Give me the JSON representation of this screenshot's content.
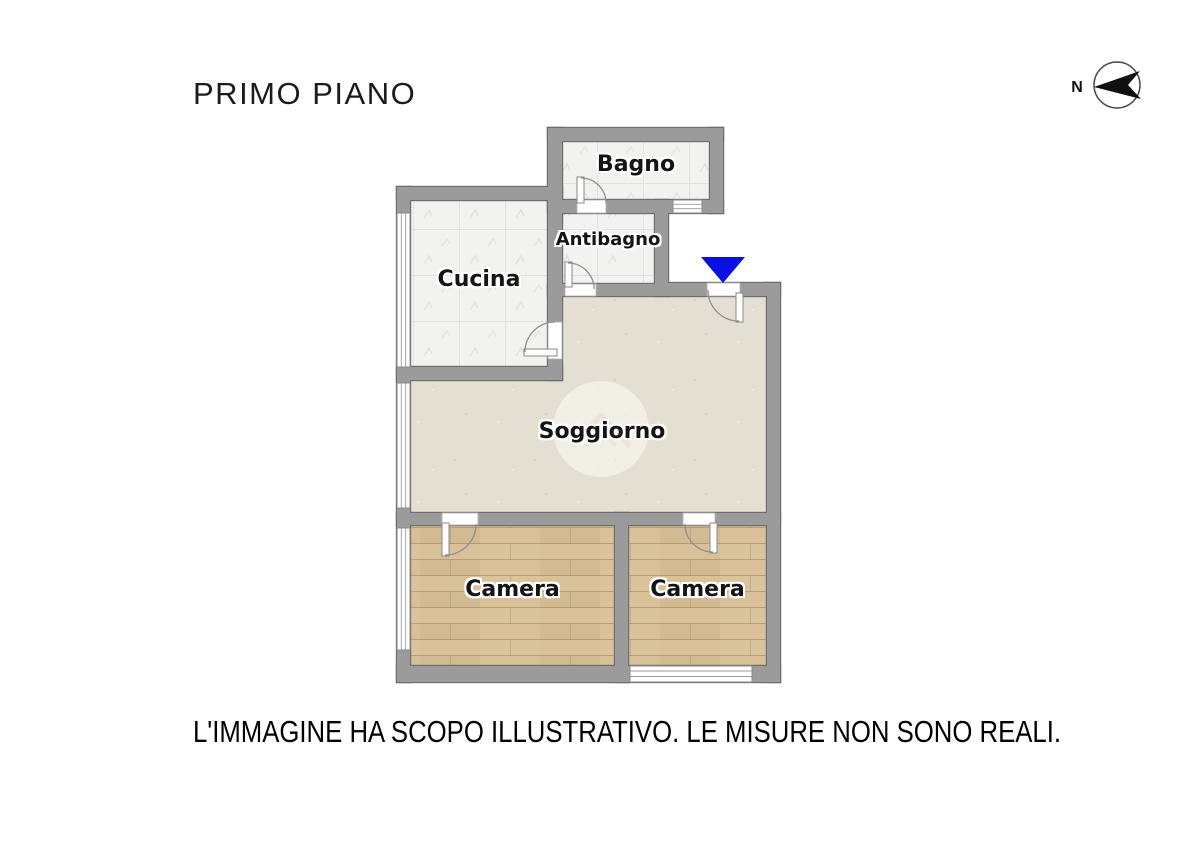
{
  "header": {
    "title": "PRIMO PIANO"
  },
  "compass": {
    "label": "N"
  },
  "rooms": {
    "bagno": {
      "label": "Bagno"
    },
    "antibagno": {
      "label": "Antibagno"
    },
    "cucina": {
      "label": "Cucina"
    },
    "soggiorno": {
      "label": "Soggiorno"
    },
    "camera_left": {
      "label": "Camera"
    },
    "camera_right": {
      "label": "Camera"
    }
  },
  "footer": {
    "disclaimer": "L'IMMAGINE HA SCOPO ILLUSTRATIVO. LE MISURE NON SONO REALI."
  },
  "colors": {
    "wall": "#9b9b9b",
    "wall_outline": "#6e6e6e",
    "tile_floor": "#f2f2f0",
    "soggiorno_floor": "#e4dfd3",
    "wood_floor": "#d8c098",
    "entrance_marker": "#0a10e2",
    "label_text": "#141414"
  }
}
